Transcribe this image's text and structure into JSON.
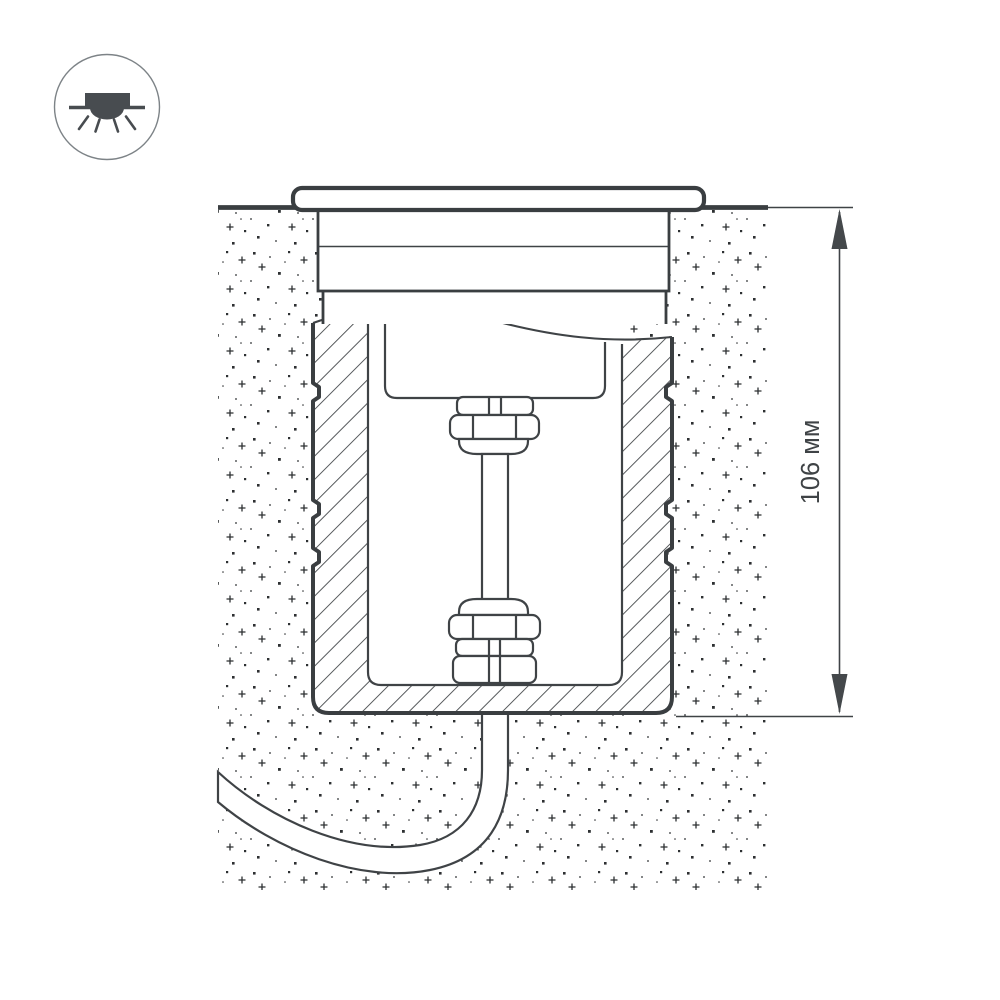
{
  "diagram": {
    "title": "recessed-inground-luminaire-installation-cross-section",
    "dimension": {
      "label": "106 мм",
      "value": "106",
      "unit": "мм",
      "measures": "embedded housing depth below ground level"
    }
  },
  "icon": {
    "name": "recessed-downlight-icon",
    "description": "round badge with recessed luminaire emitting light downward"
  },
  "colors": {
    "background": "#ffffff",
    "line": "#3f4346",
    "thick_line": "#3a3e41",
    "stipple": "#2d3032",
    "icon_glyph": "#484c50",
    "icon_circle": "#7d8387",
    "fill_white": "#ffffff"
  }
}
